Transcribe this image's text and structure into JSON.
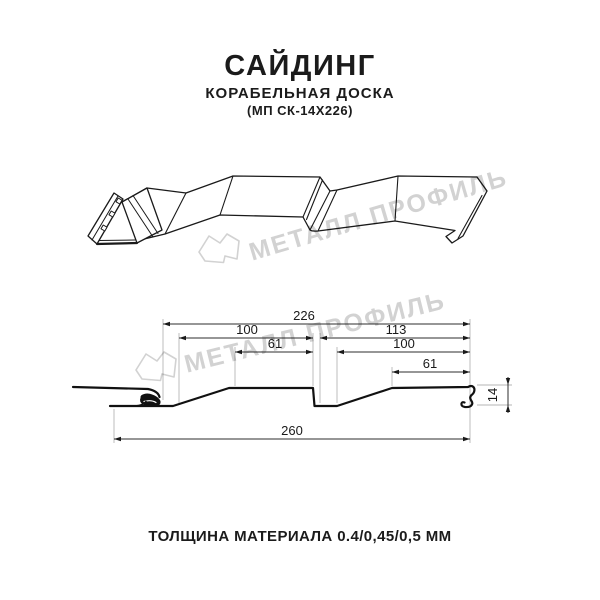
{
  "header": {
    "title": "САЙДИНГ",
    "subtitle": "КОРАБЕЛЬНАЯ ДОСКА",
    "code": "(МП СК-14Х226)"
  },
  "watermark": {
    "brand": "МЕТАЛЛ ПРОФИЛЬ"
  },
  "dimensions": {
    "overall_top": "226",
    "left_plank_width": "100",
    "right_section_width": "113",
    "left_flat_width": "61",
    "right_plank_width": "100",
    "right_flat_width": "61",
    "overall_bottom": "260",
    "profile_height": "14"
  },
  "footer": {
    "thickness_note": "ТОЛЩИНА МАТЕРИАЛА 0.4/0,45/0,5 ММ"
  },
  "colors": {
    "line": "#1a1a1a",
    "dimension": "#2e2e2e",
    "extension": "#b5b5b5",
    "watermark": "#d2d2d2",
    "background": "#ffffff"
  }
}
